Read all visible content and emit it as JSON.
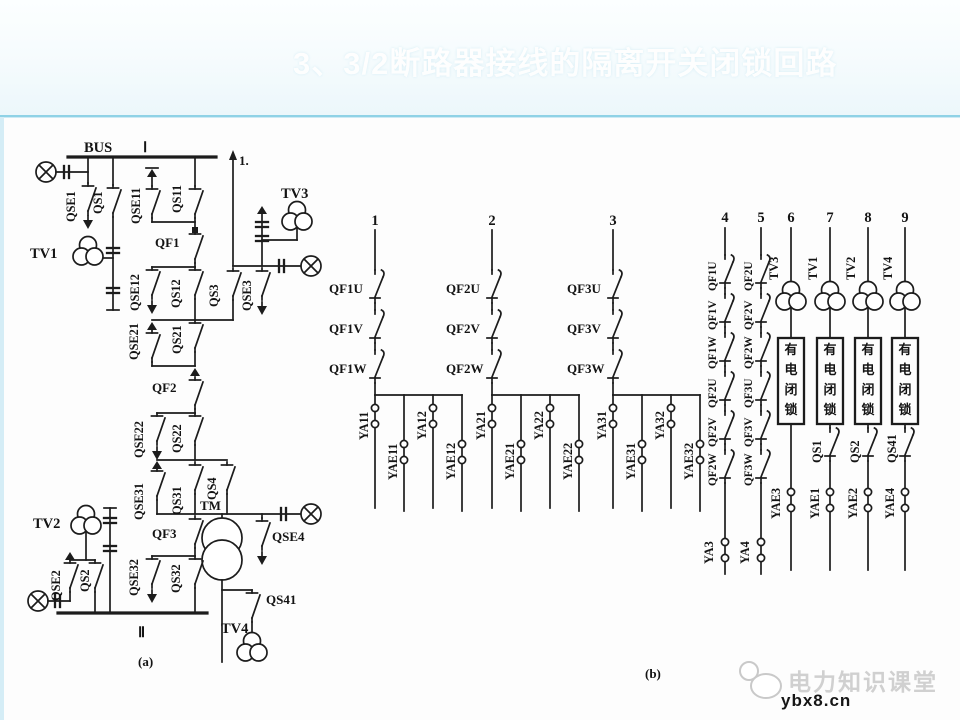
{
  "header": {
    "title": "3、3/2断路器接线的隔离开关闭锁回路"
  },
  "diagram_a": {
    "bus_top": "BUS",
    "bus_top_num": "Ⅰ",
    "bus_bottom_num": "Ⅱ",
    "feeder": "1.",
    "qse1": "QSE1",
    "qs1": "QS1",
    "tv1": "TV1",
    "qse11": "QSE11",
    "qs11": "QS11",
    "qf1": "QF1",
    "qse12": "QSE12",
    "qs12": "QS12",
    "qs3": "QS3",
    "qse3": "QSE3",
    "tv3": "TV3",
    "qse21": "QSE21",
    "qs21": "QS21",
    "qf2": "QF2",
    "qse22": "QSE22",
    "qs22": "QS22",
    "qse31": "QSE31",
    "qs31": "QS31",
    "qs4": "QS4",
    "tm": "TM",
    "qse4": "QSE4",
    "qf3": "QF3",
    "qse32": "QSE32",
    "qs32": "QS32",
    "tv2": "TV2",
    "qse2": "QSE2",
    "qs2": "QS2",
    "qs41": "QS41",
    "tv4": "TV4",
    "caption": "(a)"
  },
  "diagram_b": {
    "caption": "(b)",
    "col1": {
      "num": "1",
      "contacts": [
        "QF1U",
        "QF1V",
        "QF1W"
      ],
      "coils": [
        "YA11",
        "YAE11",
        "YA12",
        "YAE12"
      ]
    },
    "col2": {
      "num": "2",
      "contacts": [
        "QF2U",
        "QF2V",
        "QF2W"
      ],
      "coils": [
        "YA21",
        "YAE21",
        "YA22",
        "YAE22"
      ]
    },
    "col3": {
      "num": "3",
      "contacts": [
        "QF3U",
        "QF3V",
        "QF3W"
      ],
      "coils": [
        "YA31",
        "YAE31",
        "YA32",
        "YAE32"
      ]
    },
    "col4": {
      "num": "4",
      "contacts": [
        "QF1U",
        "QF1V",
        "QF1W",
        "QF2U",
        "QF2V",
        "QF2W"
      ],
      "coil": "YA3"
    },
    "col5": {
      "num": "5",
      "contacts": [
        "QF2U",
        "QF2V",
        "QF2W",
        "QF3U",
        "QF3V",
        "QF3W"
      ],
      "coil": "YA4"
    },
    "interlock_chars": [
      "有",
      "电",
      "闭",
      "锁"
    ],
    "col6": {
      "num": "6",
      "tv": "TV3",
      "coil": "YAE3"
    },
    "col7": {
      "num": "7",
      "tv": "TV1",
      "switch": "QS1",
      "coil": "YAE1"
    },
    "col8": {
      "num": "8",
      "tv": "TV2",
      "switch": "QS2",
      "coil": "YAE2"
    },
    "col9": {
      "num": "9",
      "tv": "TV4",
      "switch": "QS41",
      "coil": "YAE4"
    }
  },
  "watermark": {
    "brand": "电力知识课堂",
    "site": "ybx8.cn"
  }
}
